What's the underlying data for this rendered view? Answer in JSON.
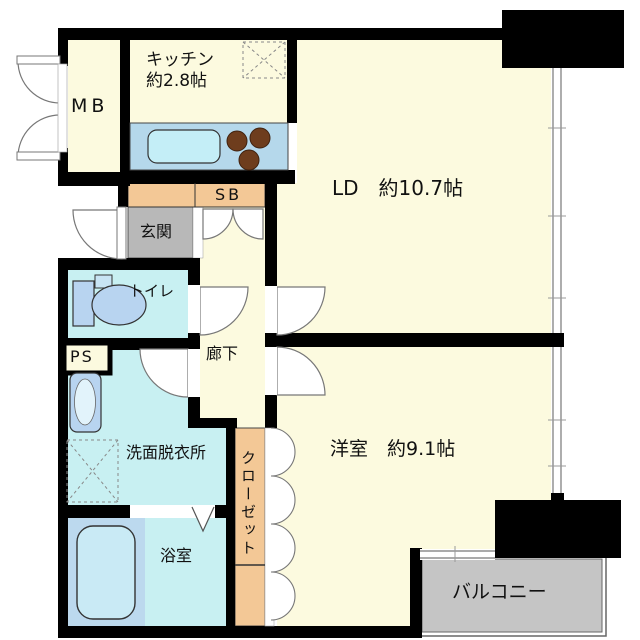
{
  "floorplan": {
    "type": "apartment-floor-plan",
    "rooms": {
      "mb": {
        "label": "MB"
      },
      "kitchen": {
        "label": "キッチン",
        "size": "約2.8帖"
      },
      "living_dining": {
        "label": "LD　約10.7帖"
      },
      "shoe_box": {
        "label": "SB"
      },
      "entrance": {
        "label": "玄関"
      },
      "toilet": {
        "label": "トイレ"
      },
      "pipe_space": {
        "label": "PS"
      },
      "hallway": {
        "label": "廊下"
      },
      "washroom": {
        "label": "洗面脱衣所"
      },
      "closet": {
        "label": "クローゼット"
      },
      "bathroom": {
        "label": "浴室"
      },
      "bedroom": {
        "label": "洋室　約9.1帖"
      },
      "balcony": {
        "label": "バルコニー"
      }
    },
    "colors": {
      "room_cream": "#FCFADF",
      "wet_room_cyan": "#C8F0F2",
      "fixture_blue": "#B8D4F0",
      "counter_blue": "#B5D8EB",
      "sink_cyan": "#C4EEF7",
      "storage_peach": "#F3C896",
      "entrance_gray": "#B8B8B8",
      "balcony_gray": "#C5C5C5",
      "burner_brown": "#6E3D1D",
      "wall_black": "#000000"
    }
  }
}
